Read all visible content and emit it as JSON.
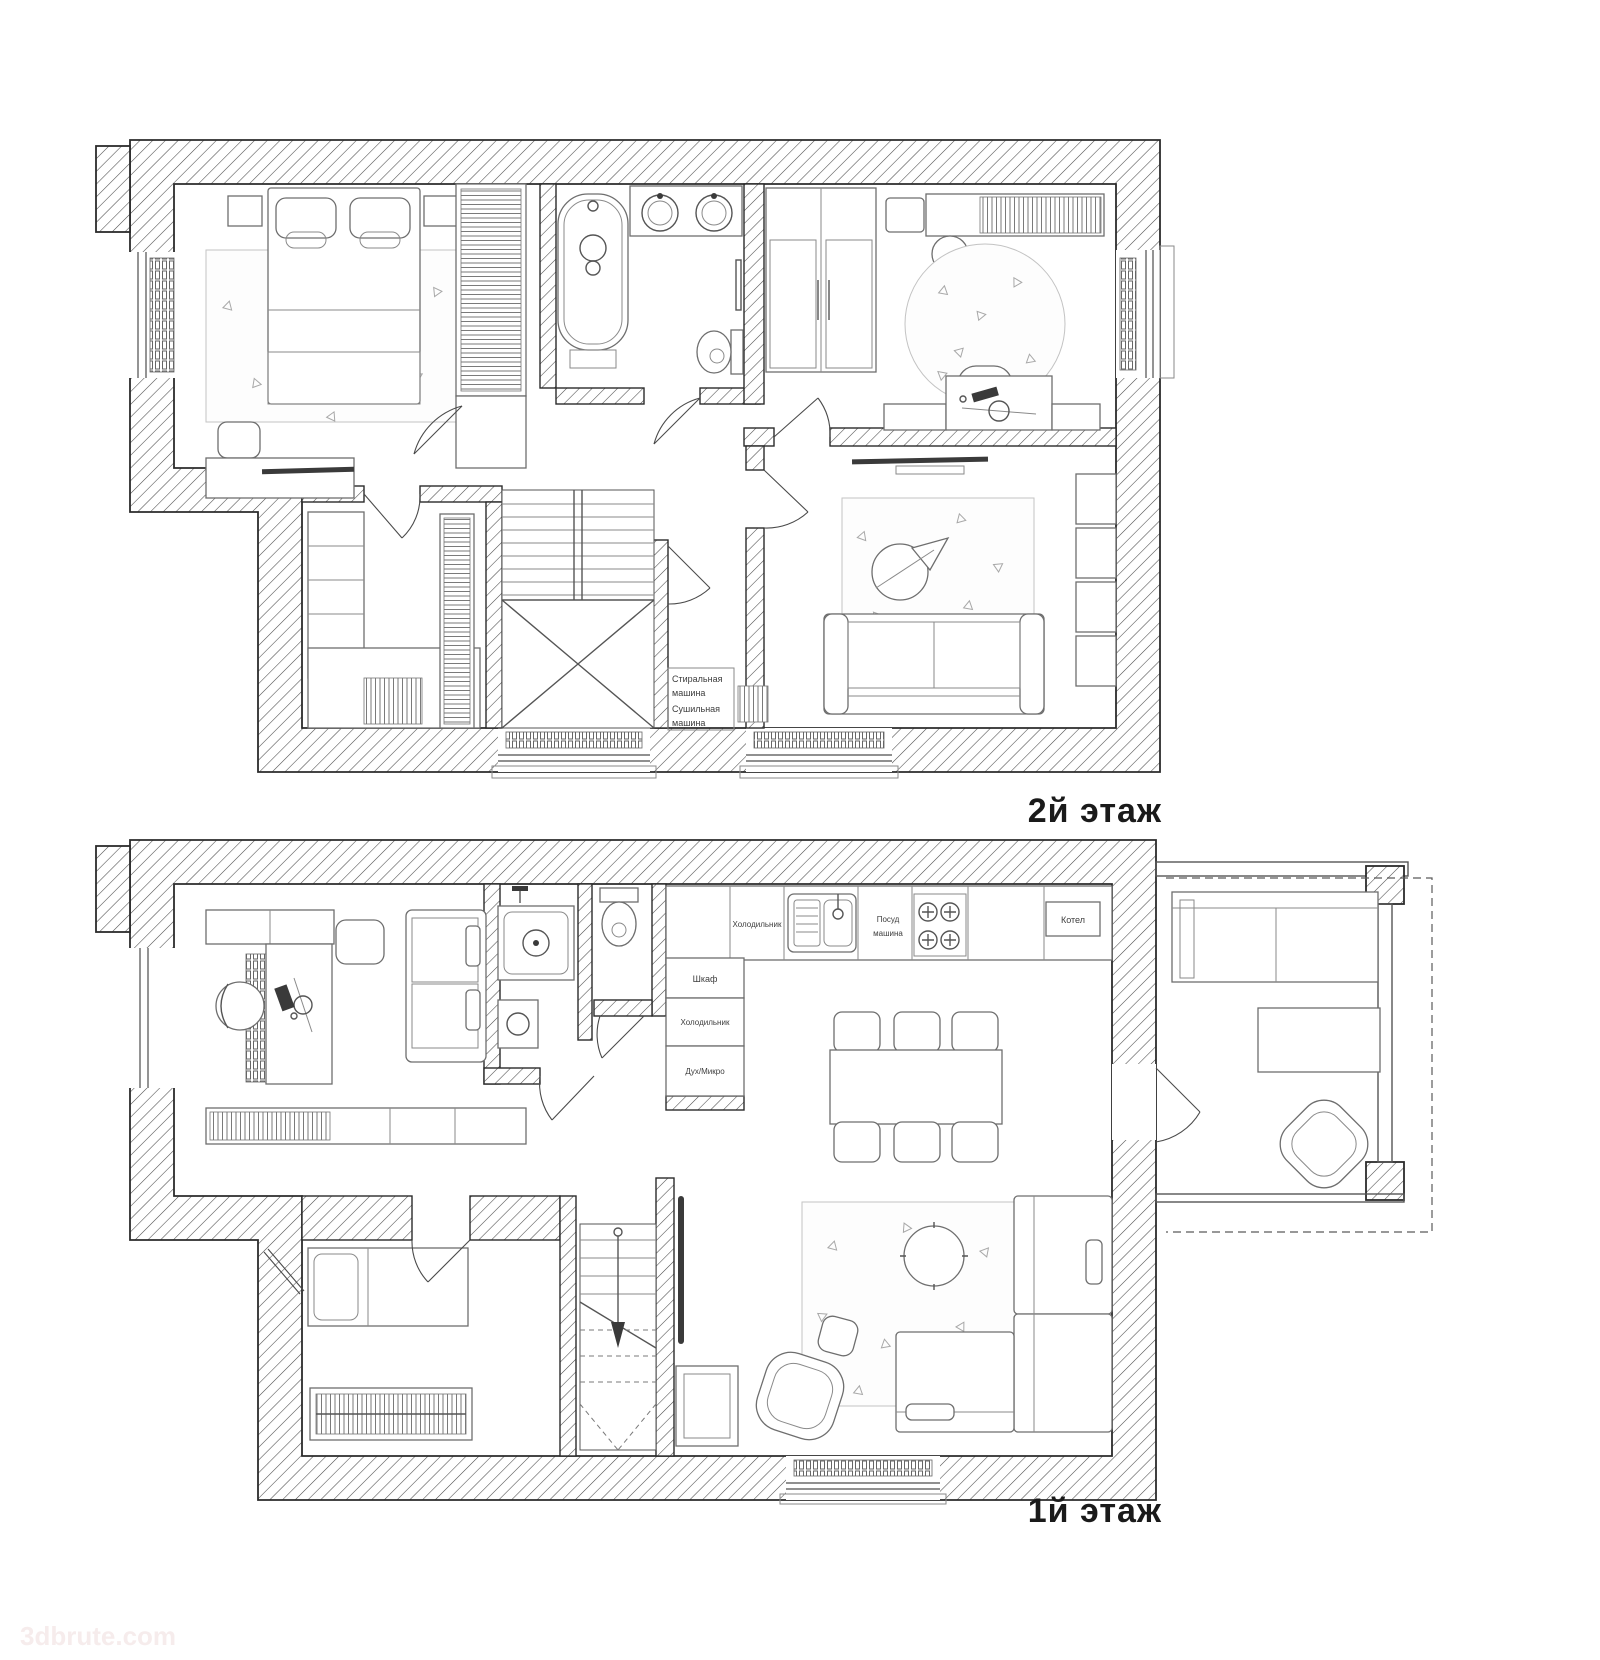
{
  "colors": {
    "background": "#ffffff",
    "wall_line": "#2b2b2b",
    "furniture_line": "#6e6e6e",
    "dark_accent": "#3a3a3a",
    "watermark": "#f6ecec"
  },
  "floors": {
    "second": {
      "label": "2й этаж"
    },
    "first": {
      "label": "1й этаж"
    }
  },
  "annotations": {
    "laundry": [
      "Стиральная",
      "машина",
      "Сушильная",
      "машина"
    ],
    "kitchen": {
      "fridge_top": "Холодильник",
      "dishwasher": [
        "Посуд",
        "машина"
      ],
      "boiler": "Котел",
      "cabinet": "Шкаф",
      "fridge_left": "Холодильник",
      "oven_micro": "Дух/Микро"
    }
  },
  "watermark": {
    "text": "3dbrute.com"
  }
}
